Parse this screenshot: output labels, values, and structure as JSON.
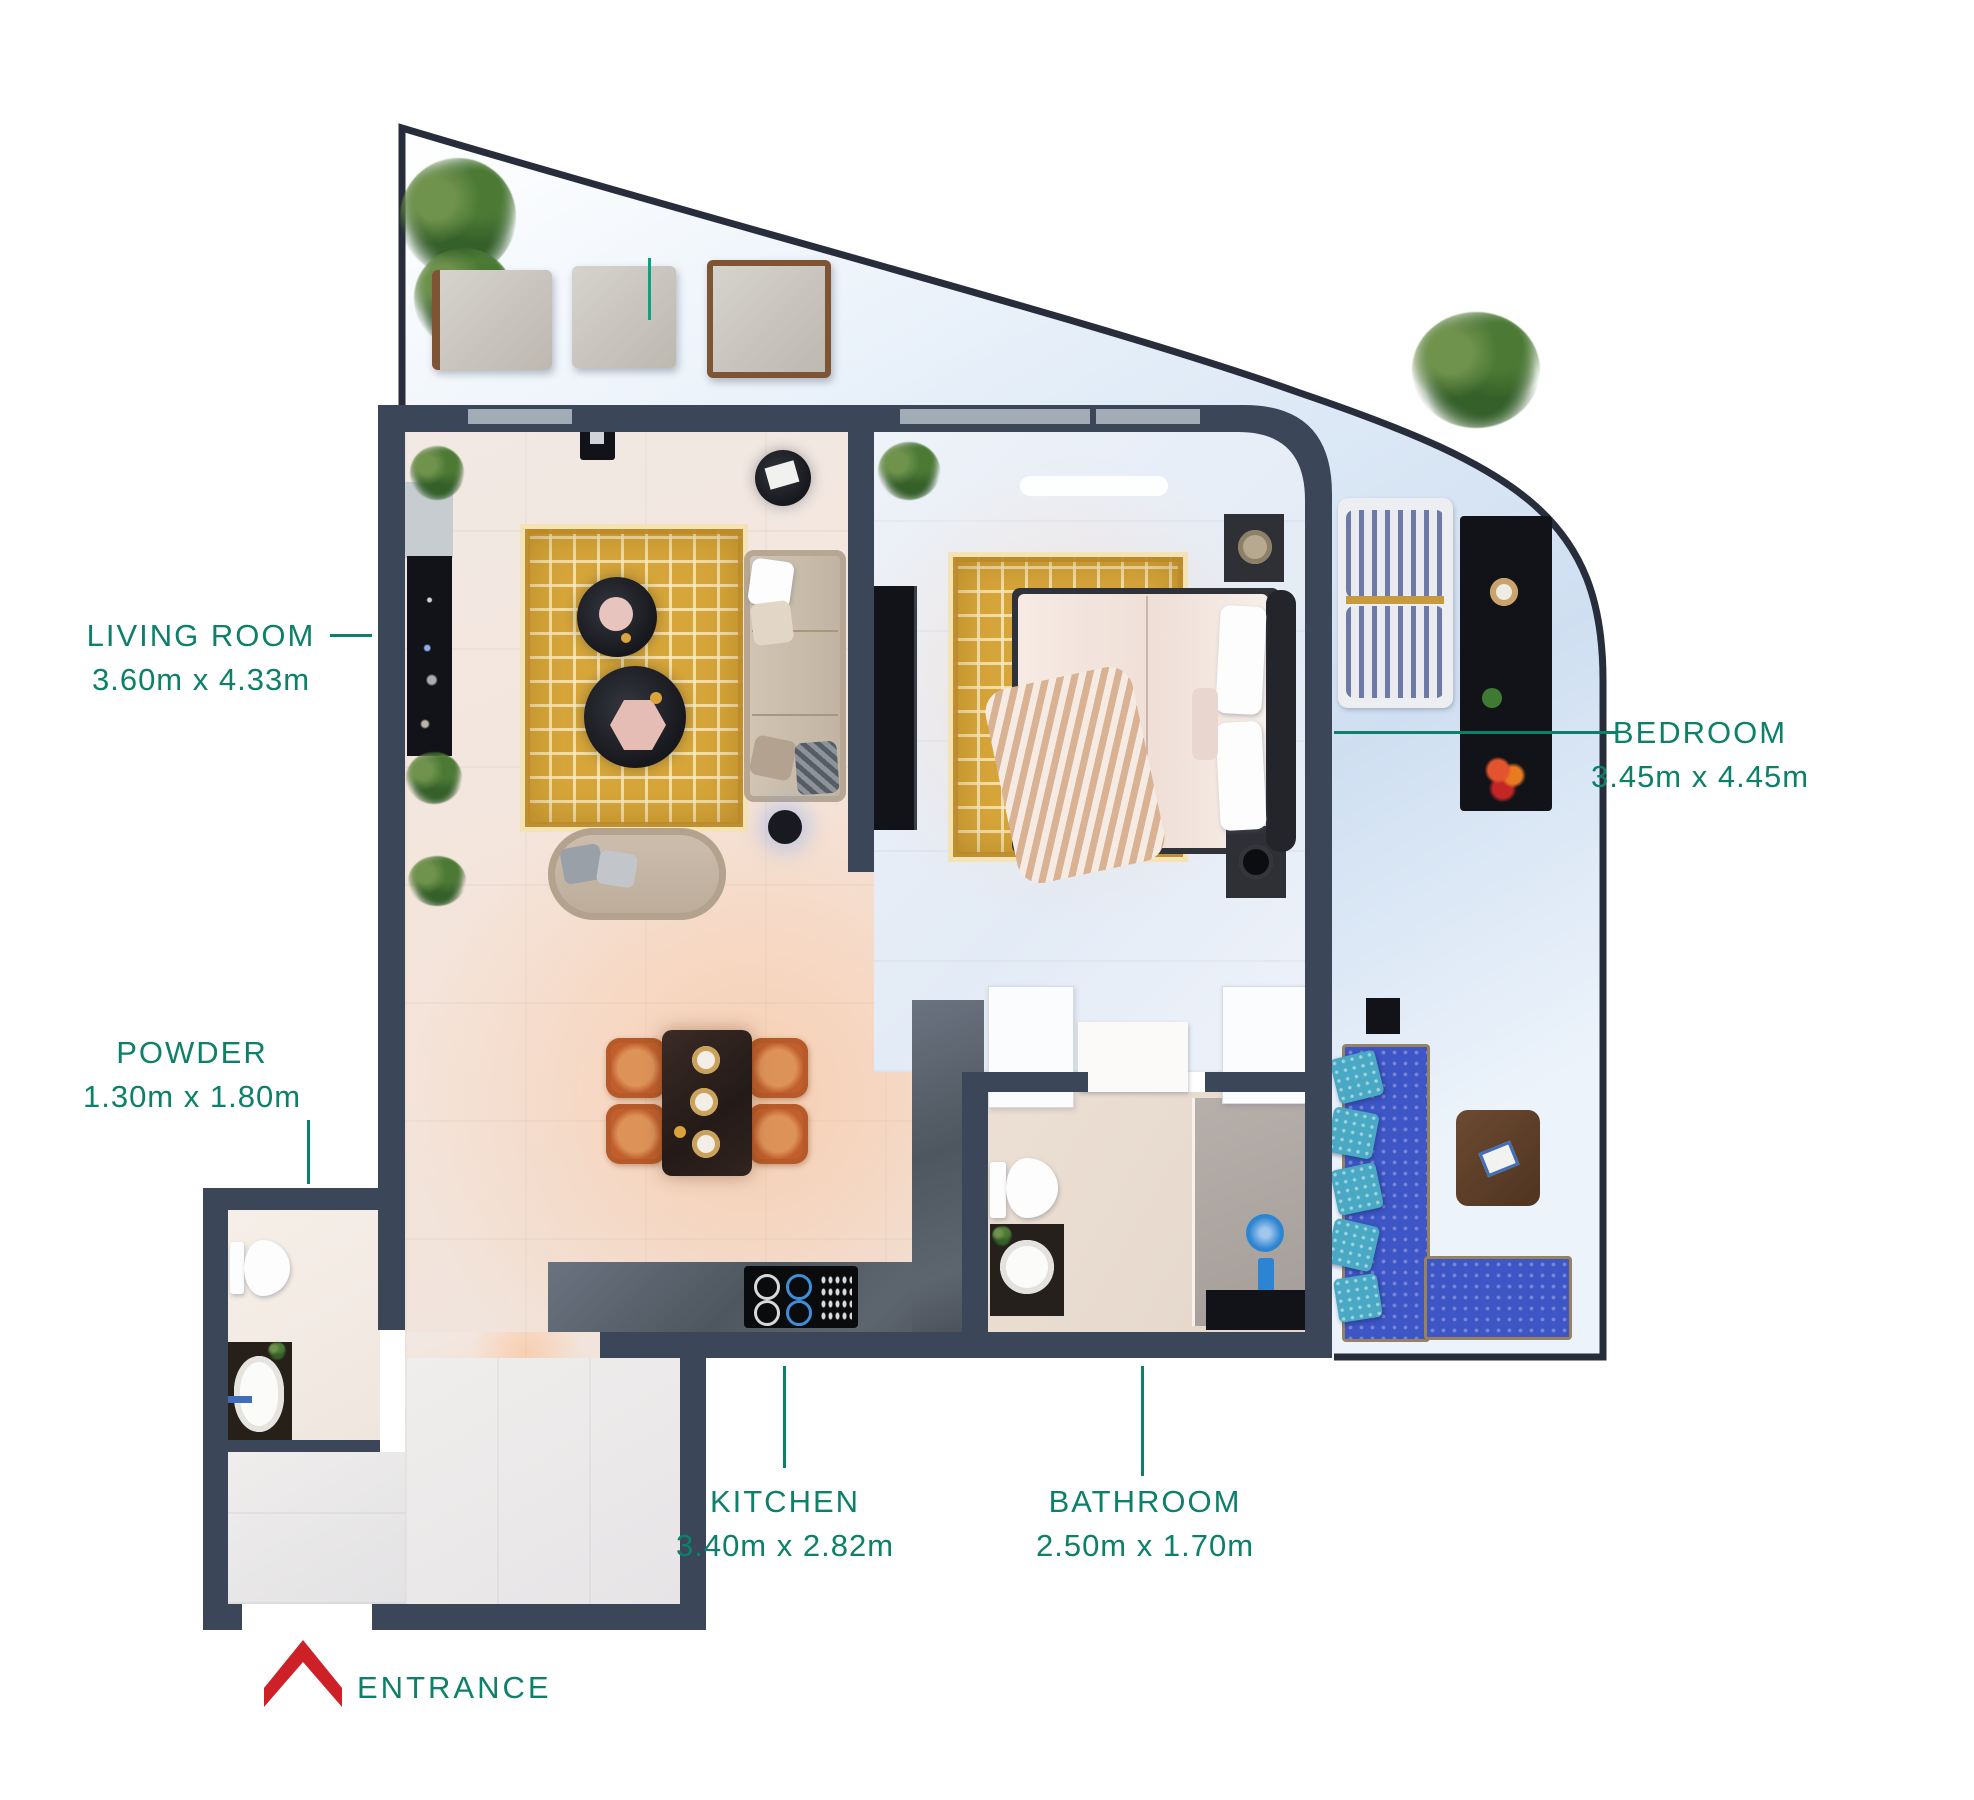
{
  "title": "Apartment unit floor plan (1 bedroom) with room dimension labels",
  "colors": {
    "label_teal": "#0D8069",
    "entrance_red": "#CE2127",
    "wall": "#3B4658",
    "railing": "#272D3B",
    "rug_gold": "#D7A63A",
    "sofa_blue": "#3D55C5",
    "chair_orange": "#C05F2D"
  },
  "labels": {
    "living_room": {
      "name": "LIVING ROOM",
      "dims": "3.60m x 4.33m"
    },
    "bedroom": {
      "name": "BEDROOM",
      "dims": "3.45m x 4.45m"
    },
    "powder": {
      "name": "POWDER",
      "dims": "1.30m x 1.80m"
    },
    "kitchen": {
      "name": "KITCHEN",
      "dims": "3.40m x 2.82m"
    },
    "bathroom": {
      "name": "BATHROOM",
      "dims": "2.50m x 1.70m"
    },
    "entrance": {
      "name": "ENTRANCE"
    }
  },
  "icons": {
    "entrance_arrow": "red chevron pointing up toward entrance door"
  }
}
